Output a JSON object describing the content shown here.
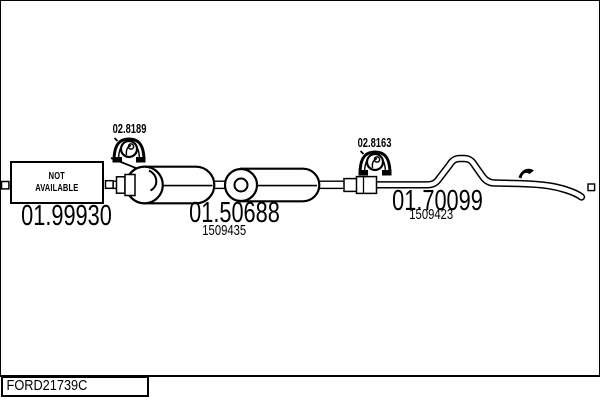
{
  "diagram": {
    "type": "exhaust-system-line-diagram",
    "catalog_code": "FORD21739C",
    "not_available": {
      "line1": "NOT",
      "line2": "AVAILABLE"
    },
    "sections": [
      {
        "name": "front-pipe",
        "part_number": "01.99930",
        "availability": "NOT AVAILABLE"
      },
      {
        "name": "centre-silencer",
        "part_number": "01.50688",
        "reference_number": "1509435"
      },
      {
        "name": "tail-pipe",
        "part_number": "01.70099",
        "reference_number": "1509423"
      }
    ],
    "clamps": [
      {
        "name": "front-clamp",
        "part_number": "02.8189"
      },
      {
        "name": "rear-clamp",
        "part_number": "02.8163"
      }
    ],
    "colors": {
      "line": "#000000",
      "background": "#ffffff"
    }
  }
}
